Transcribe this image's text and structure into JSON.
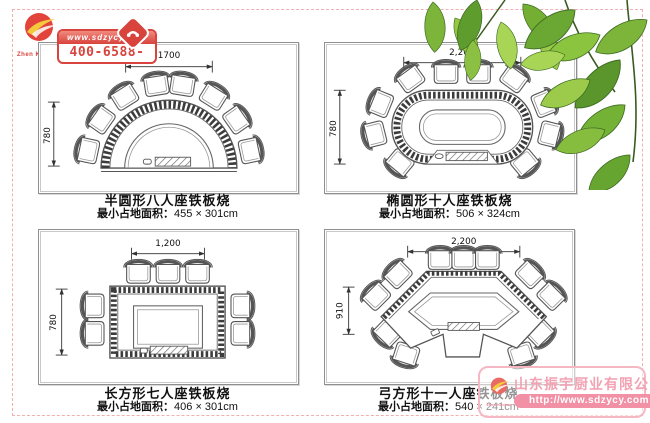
{
  "brand": {
    "name": "Zhen Kitchen",
    "color": "#d8433c"
  },
  "header_badge": {
    "website": "www.sdzycy.com",
    "phone": "400-6588-767"
  },
  "watermark": {
    "company": "山东振宇厨业有限公司",
    "url": "http://www.sdzycy.com"
  },
  "colors": {
    "accent_red": "#d8433c",
    "frame_gray": "#8f8f8f",
    "dashed_border_pink": "#f2afaf",
    "watermark_pink": "#f290a6",
    "leaf_green": "#7cb53a"
  },
  "diagrams": [
    {
      "id": "semi-circle",
      "title": "半圆形八人座铁板烧",
      "footprint_label": "最小占地面积：",
      "footprint": "455 × 301cm",
      "width_mm": "1700",
      "depth_mm": "780",
      "seats": 8
    },
    {
      "id": "oval",
      "title": "椭圆形十人座铁板烧",
      "footprint_label": "最小占地面积：",
      "footprint": "506 × 324cm",
      "width_mm": "2,200",
      "depth_mm": "780",
      "seats": 10
    },
    {
      "id": "rectangle",
      "title": "长方形七人座铁板烧",
      "footprint_label": "最小占地面积：",
      "footprint": "406 × 301cm",
      "width_mm": "1,200",
      "depth_mm": "780",
      "seats": 7
    },
    {
      "id": "bow",
      "title": "弓方形十一人座铁板烧",
      "footprint_label": "最小占地面积：",
      "footprint": "540 × 241cm",
      "width_mm": "2,200",
      "depth_mm": "910",
      "seats": 11
    }
  ]
}
